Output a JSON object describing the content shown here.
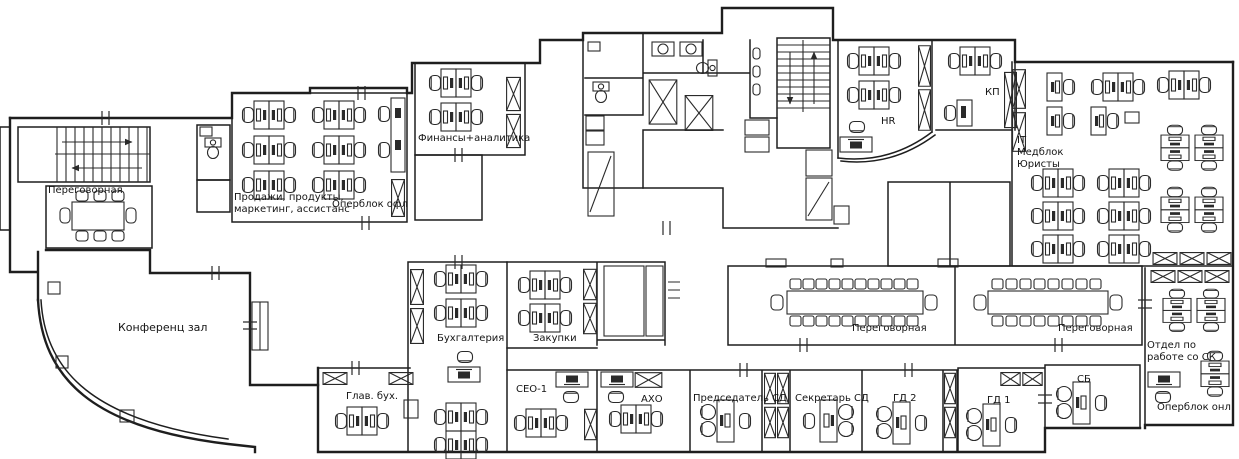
{
  "plan": {
    "title": "Office floor plan",
    "line_color": "#1e1e1e",
    "bg_color": "#ffffff",
    "rooms": {
      "meeting_nw": "Переговорная",
      "conference_hall": "Конференц зал",
      "sales": "Продажи, продукты,\nмаркетинг, ассистанс",
      "operblock_ofl": "Оперблок офл",
      "finance": "Финансы+аналитика",
      "hr": "HR",
      "kp": "КП",
      "it_block": "IT\nМедблок\nЮристы",
      "accounting": "Бухгалтерия",
      "procurement": "Закупки",
      "chief_accountant": "Глав. бух.",
      "ceo1": "СЕО-1",
      "aho": "АХО",
      "board_chairman": "Председатель СД",
      "board_secretary": "Секретарь СД",
      "gd2": "ГД 2",
      "gd1": "ГД 1",
      "sb": "СБ",
      "meeting_central": "Переговорная",
      "meeting_east": "Переговорная",
      "sk_department": "Отдел по\nработе со СК",
      "operblock_onl": "Оперблок онл"
    }
  }
}
